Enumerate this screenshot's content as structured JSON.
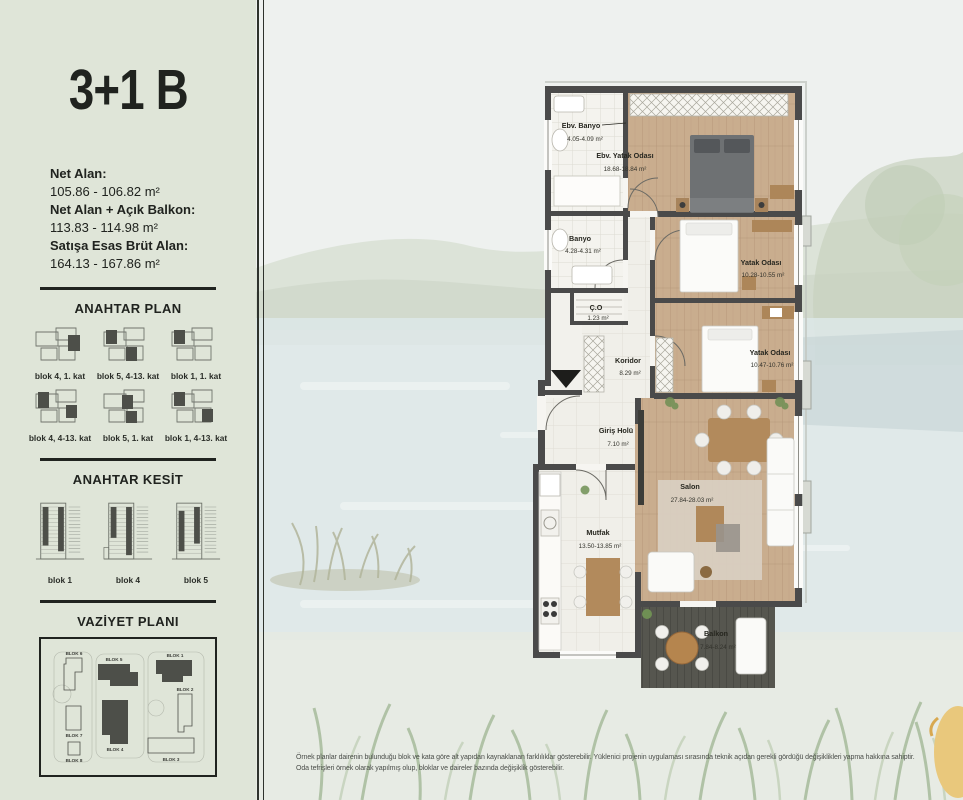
{
  "page": {
    "title": "3+1 B",
    "disclaimer_line1": "Örnek planlar dairenin bulunduğu blok ve kata göre alt yapıdan kaynaklanan farklılıklar gösterebilir. Yüklenici projenin uygulaması sırasında teknik açıdan gerekli gördüğü değişiklikleri yapma hakkına sahiptir.",
    "disclaimer_line2": "Oda tefrişleri örnek olarak yapılmış olup, bloklar ve daireler bazında değişiklik gösterebilir."
  },
  "stats": {
    "net_alan_label": "Net Alan:",
    "net_alan_value": "105.86 - 106.82 m²",
    "net_balkon_label": "Net Alan + Açık Balkon:",
    "net_balkon_value": "113.83 - 114.98 m²",
    "brut_label": "Satışa Esas Brüt Alan:",
    "brut_value": "164.13 - 167.86 m²"
  },
  "anahtar_plan": {
    "heading": "ANAHTAR PLAN",
    "captions": [
      "blok 4, 1. kat",
      "blok 5, 4-13. kat",
      "blok 1, 1. kat",
      "blok 4, 4-13. kat",
      "blok 5, 1. kat",
      "blok 1, 4-13. kat"
    ]
  },
  "anahtar_kesit": {
    "heading": "ANAHTAR KESİT",
    "captions": [
      "blok 1",
      "blok 4",
      "blok 5"
    ]
  },
  "vaziyet": {
    "heading": "VAZİYET PLANI",
    "blocks": [
      "BLOK 6",
      "BLOK 5",
      "BLOK 1",
      "BLOK 7",
      "BLOK 2",
      "BLOK 8",
      "BLOK 4",
      "BLOK 3"
    ]
  },
  "floorplan": {
    "rooms": [
      {
        "name": "Ebv. Banyo",
        "area": "4.05-4.09 m²"
      },
      {
        "name": "Ebv. Yatak Odası",
        "area": "18.68-18.84 m²"
      },
      {
        "name": "Banyo",
        "area": "4.28-4.31 m²"
      },
      {
        "name": "Ç.O",
        "area": "1.23 m²"
      },
      {
        "name": "Koridor",
        "area": "8.29 m²"
      },
      {
        "name": "Yatak Odası",
        "area": "10.28-10.55 m²"
      },
      {
        "name": "Yatak Odası",
        "area": "10.47-10.76 m²"
      },
      {
        "name": "Giriş Holü",
        "area": "7.10 m²"
      },
      {
        "name": "Mutfak",
        "area": "13.50-13.85 m²"
      },
      {
        "name": "Salon",
        "area": "27.84-28.03 m²"
      },
      {
        "name": "Balkon",
        "area": "7.84-8.24 m²"
      }
    ]
  },
  "colors": {
    "sidebar_bg": "#dfe5d8",
    "accent_dark": "#20231f",
    "wall": "#4a4a4a",
    "wood_floor": "#c9ad8e",
    "deck": "#56564f",
    "water": "#dde7e8"
  }
}
